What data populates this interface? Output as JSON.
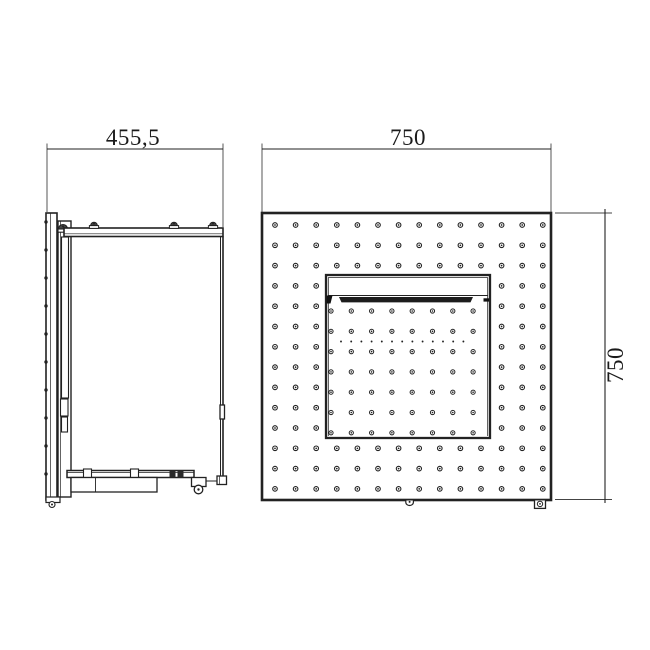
{
  "page": {
    "background": "#ffffff",
    "line_color": "#222222",
    "accent_dark": "#1d1d1d"
  },
  "views": {
    "side": {
      "name": "side-view",
      "width_dimension_label": "455,5"
    },
    "front": {
      "name": "front-view",
      "width_dimension_label": "750",
      "height_dimension_label": "750",
      "perforation_grid": {
        "cols": 14,
        "rows": 14,
        "start_x": 275,
        "start_y": 225,
        "pitch_x": 20.6,
        "pitch_y": 20.3,
        "ring_radius": 2.3,
        "center_dot_radius": 0.85
      },
      "door_grid": {
        "cols": 8,
        "rows": 7,
        "start_x": 331,
        "start_y": 311,
        "pitch_x": 20.3,
        "pitch_y": 20.3,
        "ring_radius": 2.1,
        "center_dot_radius": 0.8
      },
      "vent_dot_row": {
        "count": 13,
        "start_x": 341,
        "y": 341.5,
        "pitch": 10.2,
        "radius": 0.95
      }
    }
  }
}
